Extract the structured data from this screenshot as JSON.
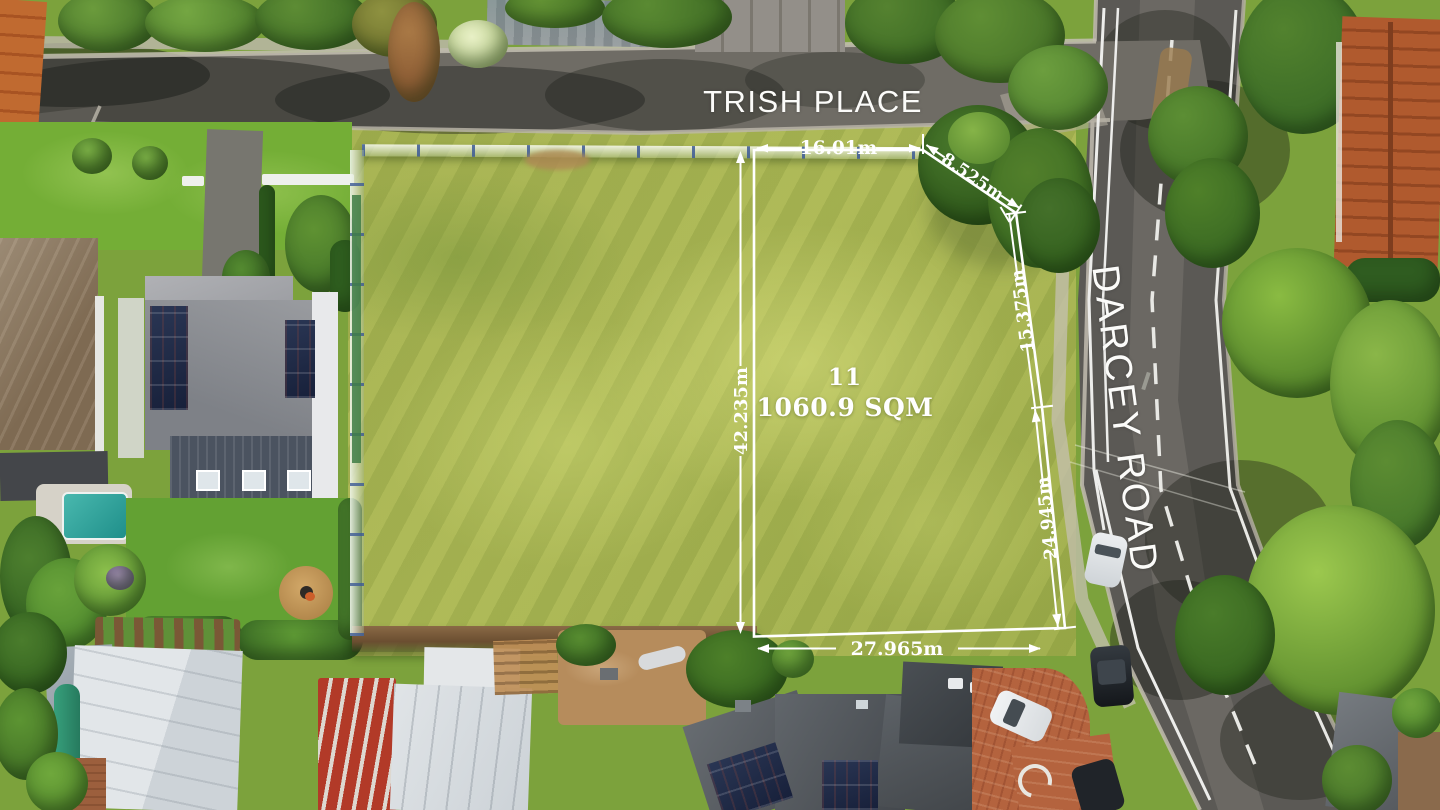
{
  "streets": {
    "trish_place": "TRISH PLACE",
    "darcey_road": "DARCEY ROAD"
  },
  "lot": {
    "number": "11",
    "area": "1060.9 SQM"
  },
  "dimensions": {
    "top": "16.01m",
    "splay": "8.525m",
    "right_upper": "15.375m",
    "right_lower": "24.945m",
    "left": "42.235m",
    "bottom": "27.965m"
  },
  "colors": {
    "overlay_white": "#ffffff",
    "lot_grass": "#a7b352",
    "asphalt": "#5b5955",
    "terracotta_drive": "#b4633e",
    "pool_teal": "#2ba8a2"
  }
}
